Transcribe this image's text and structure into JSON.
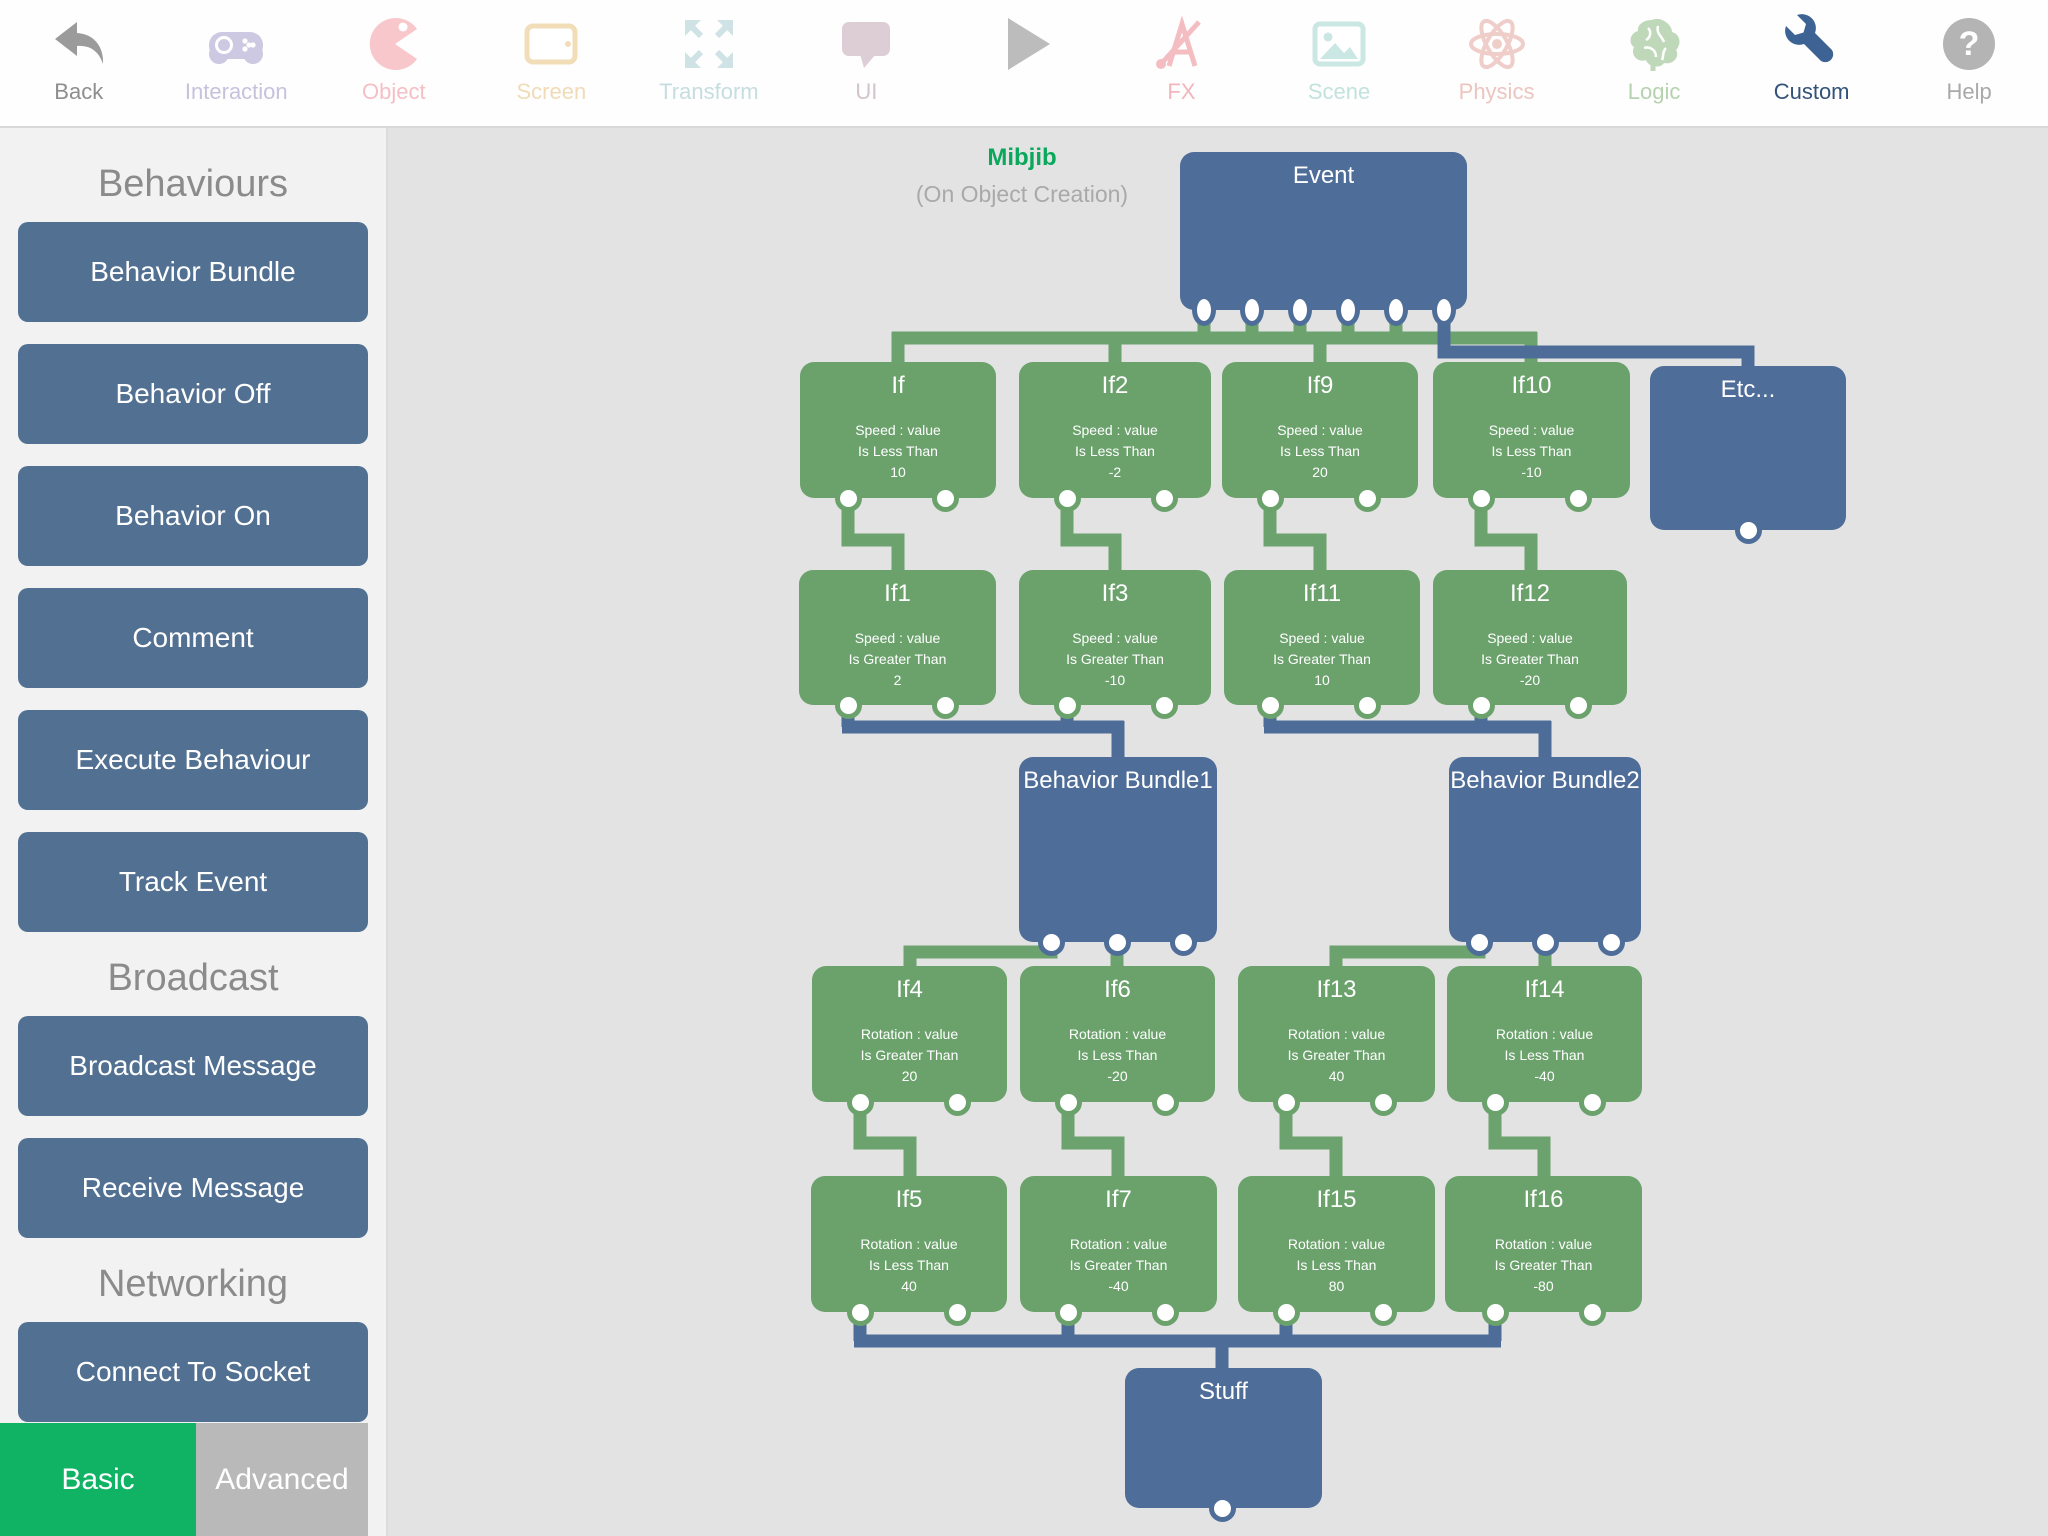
{
  "toolbar": {
    "items": [
      {
        "id": "back",
        "label": "Back",
        "icon": "back-icon",
        "icon_color": "#9b9b9b",
        "label_color": "#8e8e8e"
      },
      {
        "id": "interaction",
        "label": "Interaction",
        "icon": "gamepad-icon",
        "icon_color": "#cdc9e2",
        "label_color": "#c6c2dc"
      },
      {
        "id": "object",
        "label": "Object",
        "icon": "pacman-icon",
        "icon_color": "#f8c7cb",
        "label_color": "#f4bfc5"
      },
      {
        "id": "screen",
        "label": "Screen",
        "icon": "tablet-icon",
        "icon_color": "#f1ddb8",
        "label_color": "#efdcb6"
      },
      {
        "id": "transform",
        "label": "Transform",
        "icon": "expand-arrows-icon",
        "icon_color": "#cfe3e6",
        "label_color": "#c6dde0"
      },
      {
        "id": "ui",
        "label": "UI",
        "icon": "speech-bubble-icon",
        "icon_color": "#ddced6",
        "label_color": "#d2c4cc"
      },
      {
        "id": "play",
        "label": "",
        "icon": "play-icon",
        "icon_color": "#bcbcbc",
        "label_color": "#bcbcbc"
      },
      {
        "id": "fx",
        "label": "FX",
        "icon": "fx-ruler-icon",
        "icon_color": "#f3bdc1",
        "label_color": "#f0b6bb"
      },
      {
        "id": "scene",
        "label": "Scene",
        "icon": "image-icon",
        "icon_color": "#cbe7e3",
        "label_color": "#c2e2dd"
      },
      {
        "id": "physics",
        "label": "Physics",
        "icon": "atom-icon",
        "icon_color": "#efcdc9",
        "label_color": "#ecc5c0"
      },
      {
        "id": "logic",
        "label": "Logic",
        "icon": "brain-icon",
        "icon_color": "#bed8b9",
        "label_color": "#b5d2af"
      },
      {
        "id": "custom",
        "label": "Custom",
        "icon": "wrench-icon",
        "icon_color": "#3d6394",
        "label_color": "#33527b"
      },
      {
        "id": "help",
        "label": "Help",
        "icon": "question-icon",
        "icon_color": "#b4b4b4",
        "label_color": "#a9a9a9"
      }
    ]
  },
  "sidebar": {
    "sections": [
      {
        "title": "Behaviours",
        "buttons": [
          "Behavior Bundle",
          "Behavior Off",
          "Behavior On",
          "Comment",
          "Execute Behaviour",
          "Track Event"
        ]
      },
      {
        "title": "Broadcast",
        "buttons": [
          "Broadcast Message",
          "Receive Message"
        ]
      },
      {
        "title": "Networking",
        "buttons": [
          "Connect To Socket"
        ]
      }
    ],
    "tabs": [
      {
        "label": "Basic",
        "color": "#10b264"
      },
      {
        "label": "Advanced",
        "color": "#b9b9b9"
      }
    ]
  },
  "canvas": {
    "annotation": {
      "title": "Mibjib",
      "subtitle": "(On Object Creation)"
    },
    "colors": {
      "background": "#e3e3e3",
      "node_green": "#6ba26c",
      "node_blue": "#4e6d99",
      "wire_green": "#6ca26e",
      "wire_blue": "#4d6c98"
    },
    "nodes": [
      {
        "id": "event",
        "color": "blue",
        "title": "Event",
        "x": 1180,
        "y": 152,
        "w": 287,
        "h": 158,
        "ports": [
          1204,
          1252,
          1300,
          1348,
          1396,
          1444
        ],
        "pshape": "oval"
      },
      {
        "id": "etc",
        "color": "blue",
        "title": "Etc...",
        "x": 1650,
        "y": 366,
        "w": 196,
        "h": 164,
        "ports": [
          1748
        ]
      },
      {
        "id": "if",
        "color": "green",
        "title": "If",
        "x": 800,
        "y": 362,
        "w": 196,
        "h": 136,
        "ports": [
          848,
          945
        ],
        "lines": [
          "Speed : value",
          "Is Less Than",
          "10"
        ]
      },
      {
        "id": "if2",
        "color": "green",
        "title": "If2",
        "x": 1019,
        "y": 362,
        "w": 192,
        "h": 136,
        "ports": [
          1067,
          1164
        ],
        "lines": [
          "Speed : value",
          "Is Less Than",
          "-2"
        ]
      },
      {
        "id": "if9",
        "color": "green",
        "title": "If9",
        "x": 1222,
        "y": 362,
        "w": 196,
        "h": 136,
        "ports": [
          1270,
          1367
        ],
        "lines": [
          "Speed : value",
          "Is Less Than",
          "20"
        ]
      },
      {
        "id": "if10",
        "color": "green",
        "title": "If10",
        "x": 1433,
        "y": 362,
        "w": 197,
        "h": 136,
        "ports": [
          1481,
          1578
        ],
        "lines": [
          "Speed : value",
          "Is Less Than",
          "-10"
        ]
      },
      {
        "id": "if1",
        "color": "green",
        "title": "If1",
        "x": 799,
        "y": 570,
        "w": 197,
        "h": 135,
        "ports": [
          848,
          945
        ],
        "lines": [
          "Speed : value",
          "Is Greater Than",
          "2"
        ]
      },
      {
        "id": "if3",
        "color": "green",
        "title": "If3",
        "x": 1019,
        "y": 570,
        "w": 192,
        "h": 135,
        "ports": [
          1067,
          1164
        ],
        "lines": [
          "Speed : value",
          "Is Greater Than",
          "-10"
        ]
      },
      {
        "id": "if11",
        "color": "green",
        "title": "If11",
        "x": 1224,
        "y": 570,
        "w": 196,
        "h": 135,
        "ports": [
          1270,
          1367
        ],
        "lines": [
          "Speed : value",
          "Is Greater Than",
          "10"
        ]
      },
      {
        "id": "if12",
        "color": "green",
        "title": "If12",
        "x": 1433,
        "y": 570,
        "w": 194,
        "h": 135,
        "ports": [
          1481,
          1578
        ],
        "lines": [
          "Speed : value",
          "Is Greater Than",
          "-20"
        ]
      },
      {
        "id": "behavior-bundle1",
        "color": "blue",
        "title": "Behavior Bundle1",
        "x": 1019,
        "y": 757,
        "w": 198,
        "h": 185,
        "ports": [
          1051,
          1117,
          1183
        ]
      },
      {
        "id": "behavior-bundle2",
        "color": "blue",
        "title": "Behavior Bundle2",
        "x": 1449,
        "y": 757,
        "w": 192,
        "h": 185,
        "ports": [
          1479,
          1545,
          1611
        ]
      },
      {
        "id": "if4",
        "color": "green",
        "title": "If4",
        "x": 812,
        "y": 966,
        "w": 195,
        "h": 136,
        "ports": [
          860,
          957
        ],
        "lines": [
          "Rotation : value",
          "Is Greater Than",
          "20"
        ]
      },
      {
        "id": "if6",
        "color": "green",
        "title": "If6",
        "x": 1020,
        "y": 966,
        "w": 195,
        "h": 136,
        "ports": [
          1068,
          1165
        ],
        "lines": [
          "Rotation : value",
          "Is Less Than",
          "-20"
        ]
      },
      {
        "id": "if13",
        "color": "green",
        "title": "If13",
        "x": 1238,
        "y": 966,
        "w": 197,
        "h": 136,
        "ports": [
          1286,
          1383
        ],
        "lines": [
          "Rotation : value",
          "Is Greater Than",
          "40"
        ]
      },
      {
        "id": "if14",
        "color": "green",
        "title": "If14",
        "x": 1447,
        "y": 966,
        "w": 195,
        "h": 136,
        "ports": [
          1495,
          1592
        ],
        "lines": [
          "Rotation : value",
          "Is Less Than",
          "-40"
        ]
      },
      {
        "id": "if5",
        "color": "green",
        "title": "If5",
        "x": 811,
        "y": 1176,
        "w": 196,
        "h": 136,
        "ports": [
          860,
          957
        ],
        "lines": [
          "Rotation : value",
          "Is Less Than",
          "40"
        ]
      },
      {
        "id": "if7",
        "color": "green",
        "title": "If7",
        "x": 1020,
        "y": 1176,
        "w": 197,
        "h": 136,
        "ports": [
          1068,
          1165
        ],
        "lines": [
          "Rotation : value",
          "Is Greater Than",
          "-40"
        ]
      },
      {
        "id": "if15",
        "color": "green",
        "title": "If15",
        "x": 1238,
        "y": 1176,
        "w": 197,
        "h": 136,
        "ports": [
          1286,
          1383
        ],
        "lines": [
          "Rotation : value",
          "Is Less Than",
          "80"
        ]
      },
      {
        "id": "if16",
        "color": "green",
        "title": "If16",
        "x": 1445,
        "y": 1176,
        "w": 197,
        "h": 136,
        "ports": [
          1495,
          1592
        ],
        "lines": [
          "Rotation : value",
          "Is Greater Than",
          "-80"
        ]
      },
      {
        "id": "stuff",
        "color": "blue",
        "title": "Stuff",
        "x": 1125,
        "y": 1368,
        "w": 197,
        "h": 140,
        "ports": [
          1222
        ]
      }
    ],
    "wires": [
      {
        "c": "g",
        "pts": [
          [
            1204,
            302
          ],
          [
            1204,
            344
          ]
        ]
      },
      {
        "c": "g",
        "pts": [
          [
            1252,
            302
          ],
          [
            1252,
            344
          ]
        ]
      },
      {
        "c": "g",
        "pts": [
          [
            1300,
            302
          ],
          [
            1300,
            344
          ]
        ]
      },
      {
        "c": "g",
        "pts": [
          [
            1348,
            302
          ],
          [
            1348,
            344
          ]
        ]
      },
      {
        "c": "g",
        "pts": [
          [
            1396,
            302
          ],
          [
            1396,
            344
          ]
        ]
      },
      {
        "c": "g",
        "pts": [
          [
            892,
            338
          ],
          [
            1537,
            338
          ]
        ]
      },
      {
        "c": "g",
        "pts": [
          [
            898,
            332
          ],
          [
            898,
            368
          ]
        ]
      },
      {
        "c": "g",
        "pts": [
          [
            1115,
            332
          ],
          [
            1115,
            368
          ]
        ]
      },
      {
        "c": "g",
        "pts": [
          [
            1320,
            332
          ],
          [
            1320,
            368
          ]
        ]
      },
      {
        "c": "g",
        "pts": [
          [
            1531,
            332
          ],
          [
            1531,
            368
          ]
        ]
      },
      {
        "c": "b",
        "pts": [
          [
            1444,
            302
          ],
          [
            1444,
            352
          ],
          [
            1748,
            352
          ],
          [
            1748,
            372
          ]
        ]
      },
      {
        "c": "g",
        "pts": [
          [
            848,
            494
          ],
          [
            848,
            540
          ],
          [
            898,
            540
          ],
          [
            898,
            576
          ]
        ]
      },
      {
        "c": "g",
        "pts": [
          [
            1067,
            494
          ],
          [
            1067,
            540
          ],
          [
            1115,
            540
          ],
          [
            1115,
            576
          ]
        ]
      },
      {
        "c": "g",
        "pts": [
          [
            1270,
            494
          ],
          [
            1270,
            540
          ],
          [
            1320,
            540
          ],
          [
            1320,
            576
          ]
        ]
      },
      {
        "c": "g",
        "pts": [
          [
            1481,
            494
          ],
          [
            1481,
            540
          ],
          [
            1531,
            540
          ],
          [
            1531,
            576
          ]
        ]
      },
      {
        "c": "b",
        "pts": [
          [
            848,
            700
          ],
          [
            848,
            727
          ]
        ]
      },
      {
        "c": "b",
        "pts": [
          [
            1067,
            700
          ],
          [
            1067,
            727
          ]
        ]
      },
      {
        "c": "b",
        "pts": [
          [
            842,
            727
          ],
          [
            1124,
            727
          ]
        ]
      },
      {
        "c": "b",
        "pts": [
          [
            1118,
            721
          ],
          [
            1118,
            763
          ]
        ]
      },
      {
        "c": "b",
        "pts": [
          [
            1270,
            700
          ],
          [
            1270,
            727
          ]
        ]
      },
      {
        "c": "b",
        "pts": [
          [
            1481,
            700
          ],
          [
            1481,
            727
          ]
        ]
      },
      {
        "c": "b",
        "pts": [
          [
            1264,
            727
          ],
          [
            1551,
            727
          ]
        ]
      },
      {
        "c": "b",
        "pts": [
          [
            1545,
            721
          ],
          [
            1545,
            763
          ]
        ]
      },
      {
        "c": "g",
        "pts": [
          [
            1051,
            936
          ],
          [
            1051,
            952
          ],
          [
            910,
            952
          ],
          [
            910,
            972
          ]
        ]
      },
      {
        "c": "g",
        "pts": [
          [
            1117,
            936
          ],
          [
            1117,
            972
          ]
        ]
      },
      {
        "c": "g",
        "pts": [
          [
            1479,
            936
          ],
          [
            1479,
            952
          ],
          [
            1336,
            952
          ],
          [
            1336,
            972
          ]
        ]
      },
      {
        "c": "g",
        "pts": [
          [
            1545,
            936
          ],
          [
            1545,
            972
          ]
        ]
      },
      {
        "c": "g",
        "pts": [
          [
            860,
            1098
          ],
          [
            860,
            1143
          ],
          [
            910,
            1143
          ],
          [
            910,
            1180
          ]
        ]
      },
      {
        "c": "g",
        "pts": [
          [
            1068,
            1098
          ],
          [
            1068,
            1143
          ],
          [
            1118,
            1143
          ],
          [
            1118,
            1180
          ]
        ]
      },
      {
        "c": "g",
        "pts": [
          [
            1286,
            1098
          ],
          [
            1286,
            1143
          ],
          [
            1336,
            1143
          ],
          [
            1336,
            1180
          ]
        ]
      },
      {
        "c": "g",
        "pts": [
          [
            1495,
            1098
          ],
          [
            1495,
            1143
          ],
          [
            1544,
            1143
          ],
          [
            1544,
            1180
          ]
        ]
      },
      {
        "c": "b",
        "pts": [
          [
            860,
            1304
          ],
          [
            860,
            1341
          ]
        ]
      },
      {
        "c": "b",
        "pts": [
          [
            1068,
            1304
          ],
          [
            1068,
            1341
          ]
        ]
      },
      {
        "c": "b",
        "pts": [
          [
            1286,
            1304
          ],
          [
            1286,
            1341
          ]
        ]
      },
      {
        "c": "b",
        "pts": [
          [
            1495,
            1304
          ],
          [
            1495,
            1341
          ]
        ]
      },
      {
        "c": "b",
        "pts": [
          [
            854,
            1341
          ],
          [
            1501,
            1341
          ]
        ]
      },
      {
        "c": "b",
        "pts": [
          [
            1222,
            1335
          ],
          [
            1222,
            1372
          ]
        ]
      }
    ]
  }
}
